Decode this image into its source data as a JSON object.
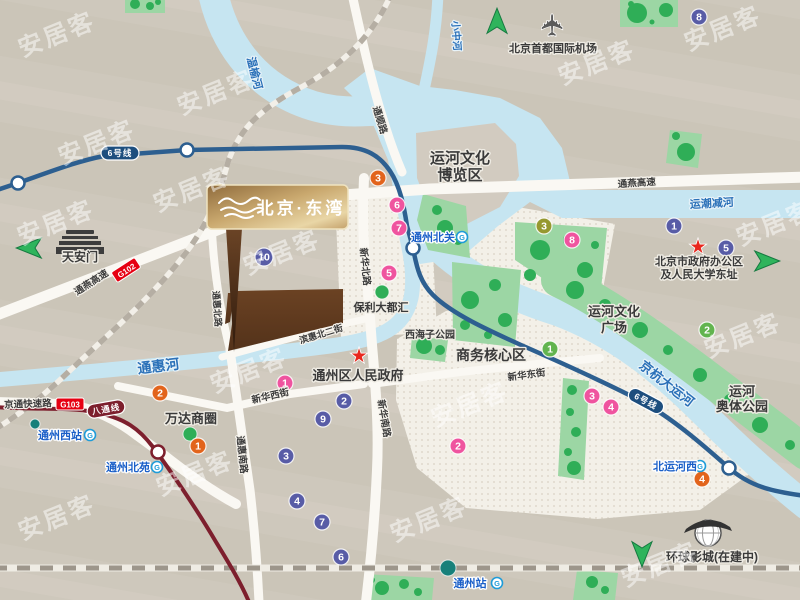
{
  "watermark": {
    "text": "安居客"
  },
  "brand_sign": {
    "title": "北京·东湾",
    "logo": "wave-icon"
  },
  "icons": {
    "airport": "✈",
    "star": "★"
  },
  "colors": {
    "background": "#cdc6bb",
    "water": "#c6e5f1",
    "park": "#9cd6a4",
    "tree": "#2fae57",
    "road": "#faf8f3",
    "hatch_zone": "#f3f0e8",
    "site_brown": "#5e3a1f",
    "line6": "#2d5f90",
    "line6_dark": "#1d4e7e",
    "batong_line": "#7d1f2d",
    "railway": "#b5aea3",
    "arrow": "#2fb45c",
    "badge_purple": "#585ca6",
    "badge_pink": "#ef549f",
    "badge_orange": "#e2641c",
    "badge_olive": "#96982f",
    "badge_green": "#62b44f",
    "highway_shield": "#e60012",
    "star": "#e8281e",
    "metro_logo": "#1f9cd8",
    "station_text": "#1a5fc8",
    "river_text": "#2a70b8",
    "sign_gold": "#c9a86e"
  },
  "transit": {
    "metro_logo_letter": "G",
    "line_badges": [
      {
        "text": "6号线",
        "x": 120,
        "y": 153,
        "rot": 0,
        "line": "line6"
      },
      {
        "text": "6号线",
        "x": 646,
        "y": 401,
        "rot": 28,
        "line": "line6"
      },
      {
        "text": "八通线",
        "x": 106,
        "y": 409,
        "rot": -10,
        "line": "batong"
      }
    ],
    "stations": [
      {
        "name": "通州北关",
        "x": 433,
        "y": 241,
        "icon_x": 462,
        "icon_y": 237
      },
      {
        "name": "通州西站",
        "x": 60,
        "y": 439,
        "icon_x": 90,
        "icon_y": 435
      },
      {
        "name": "通州北苑",
        "x": 128,
        "y": 471,
        "icon_x": 157,
        "icon_y": 467
      },
      {
        "name": "北运河西",
        "x": 675,
        "y": 470,
        "icon_x": 700,
        "icon_y": 466
      },
      {
        "name": "通州站",
        "x": 470,
        "y": 587,
        "icon_x": 497,
        "icon_y": 583
      }
    ]
  },
  "highway_shields": [
    {
      "code": "G102",
      "x": 126,
      "y": 270,
      "rot": -33
    },
    {
      "code": "G103",
      "x": 70,
      "y": 404,
      "rot": 0
    }
  ],
  "road_labels": [
    {
      "t": "通燕高速",
      "x": 93,
      "y": 285,
      "rot": -33,
      "size": 9.5
    },
    {
      "t": "通燕高速",
      "x": 637,
      "y": 186,
      "rot": -4,
      "size": 9.5
    },
    {
      "t": "京通快速路",
      "x": 28,
      "y": 407,
      "rot": -2,
      "size": 9.5
    },
    {
      "t": "通顺路",
      "x": 377,
      "y": 121,
      "rot": 73,
      "size": 9.5
    },
    {
      "t": "新华北路",
      "x": 362,
      "y": 267,
      "rot": 84,
      "size": 9.5
    },
    {
      "t": "新华南路",
      "x": 381,
      "y": 419,
      "rot": 80,
      "size": 9.5
    },
    {
      "t": "滨惠北二街",
      "x": 322,
      "y": 337,
      "rot": -17,
      "size": 9
    },
    {
      "t": "新华西街",
      "x": 271,
      "y": 399,
      "rot": -13,
      "size": 9.5
    },
    {
      "t": "新华东街",
      "x": 527,
      "y": 378,
      "rot": -8,
      "size": 9.5
    },
    {
      "t": "通惠南路",
      "x": 239,
      "y": 455,
      "rot": 84,
      "size": 9.5
    },
    {
      "t": "通惠北路",
      "x": 214,
      "y": 309,
      "rot": 86,
      "size": 9
    }
  ],
  "river_labels": [
    {
      "t": "温榆河",
      "x": 251,
      "y": 74,
      "rot": 76,
      "size": 11
    },
    {
      "t": "小中河",
      "x": 453,
      "y": 36,
      "rot": 86,
      "size": 10
    },
    {
      "t": "运潮减河",
      "x": 712,
      "y": 207,
      "rot": -3,
      "size": 11
    },
    {
      "t": "通惠河",
      "x": 159,
      "y": 371,
      "rot": -7,
      "size": 14
    },
    {
      "t": "京杭大运河",
      "x": 664,
      "y": 387,
      "rot": 38,
      "size": 13
    }
  ],
  "area_labels": [
    {
      "lines": [
        "运河文化",
        "博览区"
      ],
      "x": 460,
      "y": 163,
      "lh": 17,
      "size": 15
    },
    {
      "lines": [
        "商务核心区"
      ],
      "x": 491,
      "y": 360,
      "size": 14
    },
    {
      "lines": [
        "运河文化",
        "广场"
      ],
      "x": 614,
      "y": 316,
      "lh": 16,
      "size": 13
    },
    {
      "lines": [
        "运河",
        "奥体公园"
      ],
      "x": 742,
      "y": 396,
      "lh": 15,
      "size": 13
    },
    {
      "lines": [
        "西海子公园"
      ],
      "x": 430,
      "y": 338,
      "size": 10
    }
  ],
  "poi_labels": [
    {
      "lines": [
        "天安门"
      ],
      "x": 80,
      "y": 261,
      "size": 12
    },
    {
      "lines": [
        "北京首都国际机场"
      ],
      "x": 553,
      "y": 52,
      "size": 11
    },
    {
      "lines": [
        "北京市政府办公区",
        "及人民大学东址"
      ],
      "x": 699,
      "y": 265,
      "lh": 13,
      "size": 11
    },
    {
      "lines": [
        "通州区人民政府"
      ],
      "x": 358,
      "y": 380,
      "size": 13
    },
    {
      "lines": [
        "保利大都汇"
      ],
      "x": 381,
      "y": 311,
      "size": 11
    },
    {
      "lines": [
        "万达商圈"
      ],
      "x": 191,
      "y": 423,
      "size": 13
    },
    {
      "lines": [
        "环球影城(在建中)"
      ],
      "x": 712,
      "y": 561,
      "size": 12
    }
  ],
  "badges": [
    {
      "n": "8",
      "c": "purple",
      "x": 699,
      "y": 17
    },
    {
      "n": "1",
      "c": "purple",
      "x": 674,
      "y": 226
    },
    {
      "n": "5",
      "c": "purple",
      "x": 726,
      "y": 248
    },
    {
      "n": "10",
      "c": "purple",
      "x": 264,
      "y": 257,
      "r": 9
    },
    {
      "n": "2",
      "c": "purple",
      "x": 344,
      "y": 401
    },
    {
      "n": "9",
      "c": "purple",
      "x": 323,
      "y": 419
    },
    {
      "n": "3",
      "c": "purple",
      "x": 286,
      "y": 456
    },
    {
      "n": "4",
      "c": "purple",
      "x": 297,
      "y": 501
    },
    {
      "n": "7",
      "c": "purple",
      "x": 322,
      "y": 522
    },
    {
      "n": "6",
      "c": "purple",
      "x": 341,
      "y": 557
    },
    {
      "n": "6",
      "c": "pink",
      "x": 397,
      "y": 205
    },
    {
      "n": "7",
      "c": "pink",
      "x": 399,
      "y": 228
    },
    {
      "n": "5",
      "c": "pink",
      "x": 389,
      "y": 273
    },
    {
      "n": "8",
      "c": "pink",
      "x": 572,
      "y": 240
    },
    {
      "n": "1",
      "c": "pink",
      "x": 285,
      "y": 383
    },
    {
      "n": "3",
      "c": "pink",
      "x": 592,
      "y": 396
    },
    {
      "n": "4",
      "c": "pink",
      "x": 611,
      "y": 407
    },
    {
      "n": "2",
      "c": "pink",
      "x": 458,
      "y": 446
    },
    {
      "n": "3",
      "c": "orange",
      "x": 378,
      "y": 178
    },
    {
      "n": "2",
      "c": "orange",
      "x": 160,
      "y": 393
    },
    {
      "n": "1",
      "c": "orange",
      "x": 198,
      "y": 446
    },
    {
      "n": "4",
      "c": "orange",
      "x": 702,
      "y": 479
    },
    {
      "n": "3",
      "c": "olive",
      "x": 544,
      "y": 226
    },
    {
      "n": "1",
      "c": "green",
      "x": 550,
      "y": 349
    },
    {
      "n": "2",
      "c": "green",
      "x": 707,
      "y": 330
    }
  ],
  "marker_dots": [
    {
      "x": 190,
      "y": 434,
      "r": 7,
      "c": "#2fae57",
      "name": "wanda-dot"
    },
    {
      "x": 382,
      "y": 292,
      "r": 7,
      "c": "#2fae57",
      "name": "poly-plaza-dot"
    },
    {
      "x": 35,
      "y": 424,
      "r": 5,
      "c": "#17807a",
      "name": "tongzhou-west-dot"
    },
    {
      "x": 448,
      "y": 568,
      "r": 8,
      "c": "#17807a",
      "name": "tongzhou-station-dot"
    }
  ],
  "stars": [
    {
      "x": 359,
      "y": 356
    },
    {
      "x": 698,
      "y": 247
    }
  ],
  "arrows": [
    {
      "dir": "left",
      "x": 30,
      "y": 248
    },
    {
      "dir": "up",
      "x": 497,
      "y": 22
    },
    {
      "dir": "right",
      "x": 766,
      "y": 261
    },
    {
      "dir": "down",
      "x": 642,
      "y": 553
    }
  ],
  "watermark_positions": [
    [
      60,
      42
    ],
    [
      219,
      100
    ],
    [
      100,
      150
    ],
    [
      600,
      70
    ],
    [
      726,
      36
    ],
    [
      59,
      230
    ],
    [
      195,
      197
    ],
    [
      285,
      260
    ],
    [
      252,
      378
    ],
    [
      473,
      412
    ],
    [
      198,
      481
    ],
    [
      60,
      525
    ],
    [
      432,
      527
    ],
    [
      663,
      572
    ],
    [
      746,
      343
    ],
    [
      778,
      231
    ]
  ]
}
